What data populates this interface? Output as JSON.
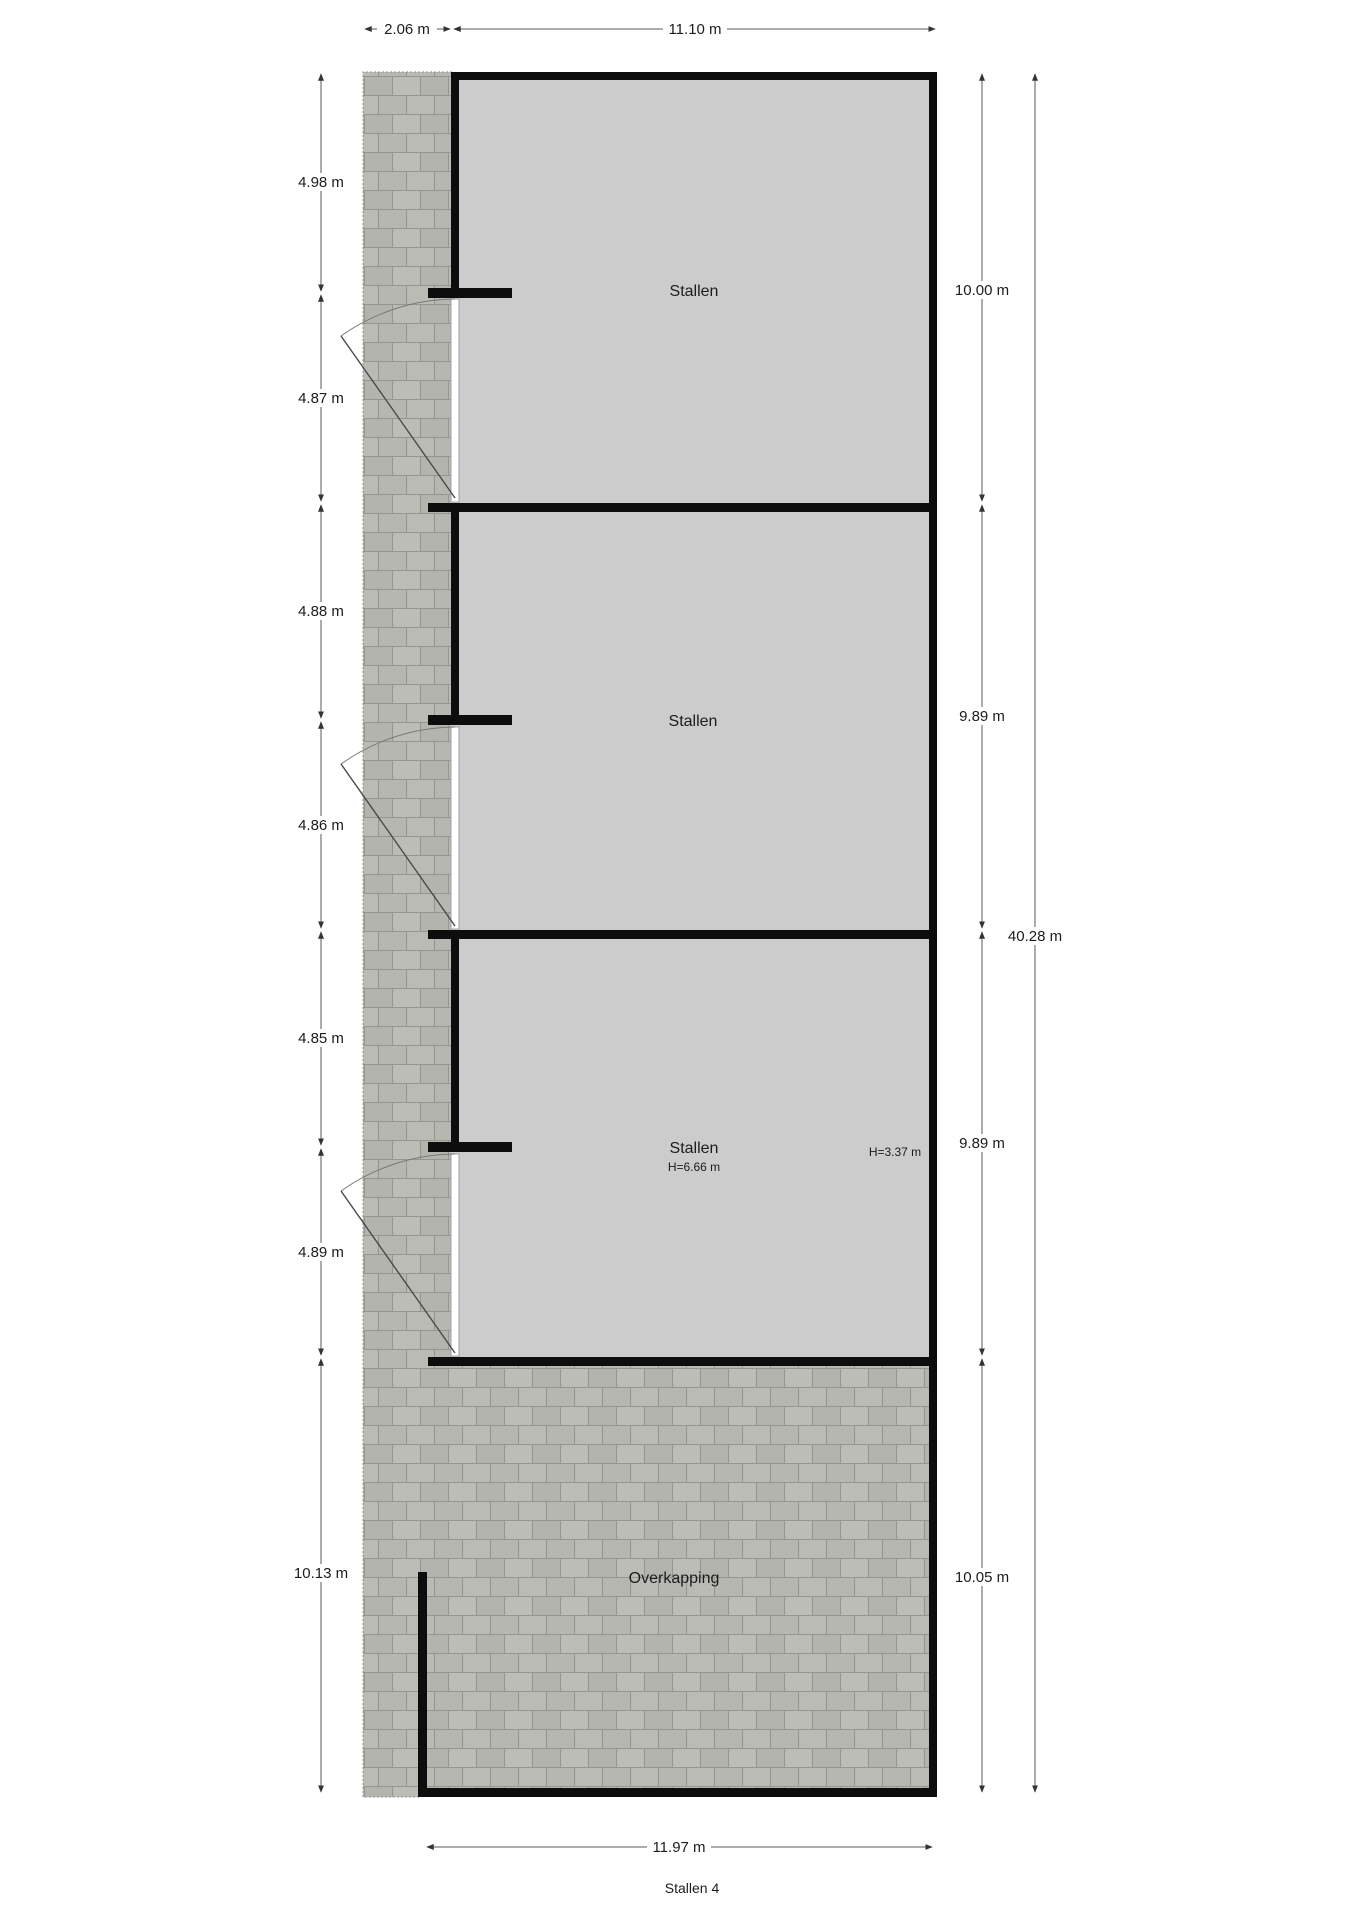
{
  "meta": {
    "title": "Stallen 4"
  },
  "rooms": [
    {
      "name": "stallen-1",
      "label": "Stallen"
    },
    {
      "name": "stallen-2",
      "label": "Stallen"
    },
    {
      "name": "stallen-3",
      "label": "Stallen",
      "ceiling_height": "H=6.66 m",
      "ceiling_height_right": "H=3.37 m"
    },
    {
      "name": "overkapping",
      "label": "Overkapping"
    }
  ],
  "dimensions": {
    "top": [
      "2.06 m",
      "11.10 m"
    ],
    "left": [
      "4.98 m",
      "4.87 m",
      "4.88 m",
      "4.86 m",
      "4.85 m",
      "4.89 m",
      "10.13 m"
    ],
    "right": [
      "10.00 m",
      "9.89 m",
      "9.89 m",
      "10.05 m"
    ],
    "overall": "40.28 m",
    "bottom": "11.97 m"
  },
  "colors": {
    "wall": "#0d0d0d",
    "room_floor": "#cccccc",
    "paving_base": "#b7b7b2",
    "paving_joint": "#96968f",
    "dimension_line": "#5a5a5a"
  }
}
